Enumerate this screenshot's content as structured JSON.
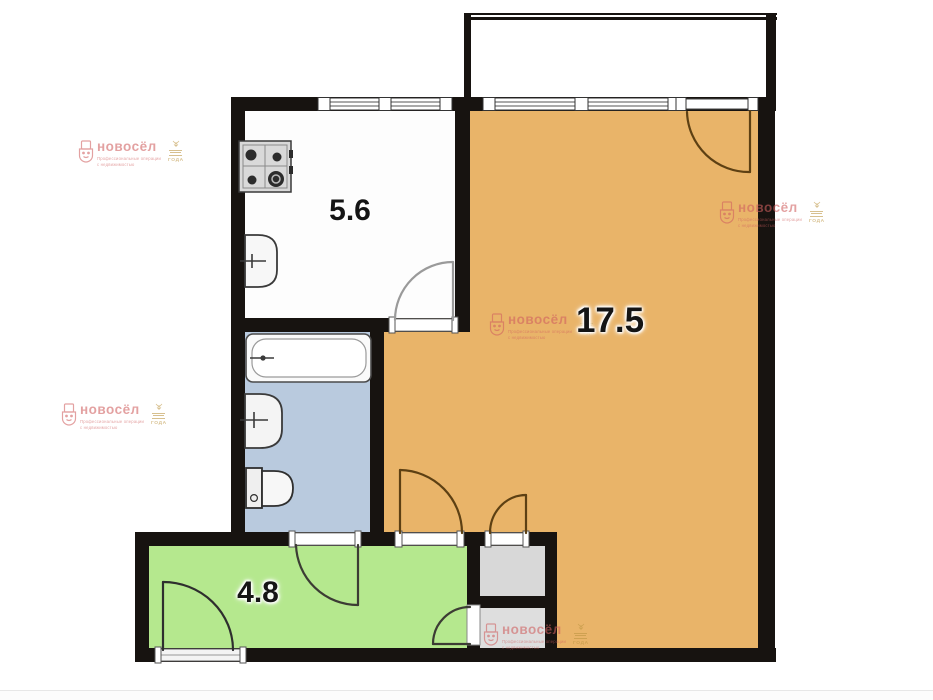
{
  "floorplan": {
    "title_note": "one-room apartment floor plan",
    "rooms": {
      "kitchen": {
        "name": "kitchen",
        "area": "5.6",
        "fill": "#fdfdfd"
      },
      "living": {
        "name": "living-room",
        "area": "17.5",
        "fill": "#e9b469"
      },
      "hall": {
        "name": "hallway",
        "area": "4.8",
        "fill": "#b5e88e"
      },
      "bathroom": {
        "name": "bathroom",
        "fill": "#b9cade"
      },
      "closet_top": {
        "name": "closet-top",
        "fill": "#d8d8d8"
      },
      "closet_bottom": {
        "name": "closet-bottom",
        "fill": "#dedede"
      },
      "balcony": {
        "name": "balcony",
        "fill": "#ffffff"
      }
    },
    "colors": {
      "wall": "#171310",
      "door_dark": "#5d4013",
      "door_gray": "#9a9a9a",
      "door_olive": "#3c3c34",
      "fixture_stroke": "#3a3a3a"
    },
    "icons": {
      "stove": "stove-icon",
      "kitchen_sink": "sink-icon",
      "bathtub": "bathtub-icon",
      "washbasin": "washbasin-icon",
      "toilet": "toilet-icon",
      "logo": "novosel-logo-icon"
    }
  },
  "watermark": {
    "brand": "новосёл",
    "tagline_line1": "Профессиональные операции",
    "tagline_line2": "с недвижимостью",
    "badge_year": "ГОДА",
    "color": "#d05f5f",
    "badge_color": "#bb9440"
  }
}
